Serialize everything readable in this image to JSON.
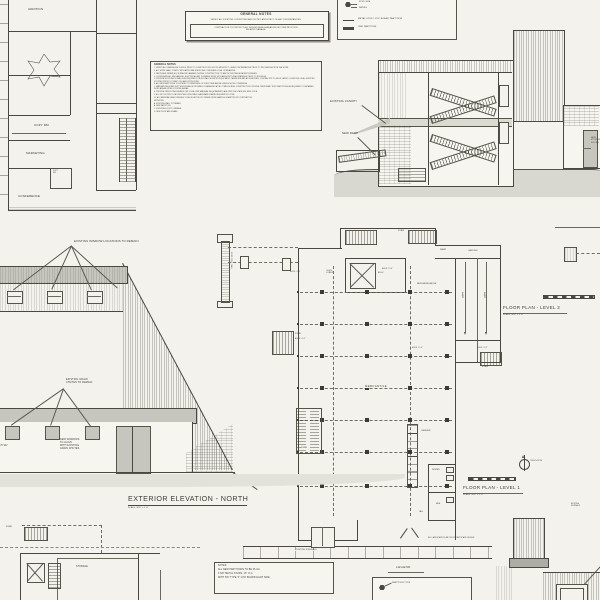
{
  "colors": {
    "paper": "#f4f2ec",
    "ink": "#4a4840",
    "gray_fill": "#c7c6be",
    "ground_gray": "#d9d8d0"
  },
  "plan_top_left": {
    "addition": "ADDITION",
    "copy_rm": "COPY RM.",
    "marketing": "MARKETING",
    "conference": "CONFERENCE",
    "copy_closet": "COPY\nRM."
  },
  "general_notes_box": {
    "title": "GENERAL NOTES",
    "line1": "VERIFY ALL EXISTING CONDITIONS AND NOTIFY ARCHITECT OF ANY DISCREPANCIES.",
    "line2": "CONTRACTOR TO PROTECT ALL NON-WORKING AREAS FROM CONSTRUCTION\nRELATED DAMAGE."
  },
  "notes_list": {
    "heading": "GENERAL NOTES",
    "items": [
      "1.  VERIFY ALL DIMENSIONS IN FIELD PRIOR TO CONSTRUCTION. NOTIFY ARCHITECT OF ANY DISCREPANCIES PRIOR TO PROCEEDING WITH THE WORK.",
      "2.  ALL WORK SHALL COMPLY WITH APPLICABLE BUILDING CODES AND LOCAL ORDINANCES.",
      "3.  PATCH AND REPAIR ALL SURFACES DAMAGED DURING CONSTRUCTION TO MATCH EXISTING ADJACENT FINISHES.",
      "4.  COORDINATE ALL MECHANICAL, ELECTRICAL AND PLUMBING WORK WITH ARCHITECTURAL DRAWINGS PRIOR TO ROUGH-IN.",
      "5.  PROVIDE BLOCKING IN WALLS AS REQUIRED FOR ALL WALL MOUNTED EQUIPMENT, CASEWORK AND ACCESSORIES. CONTRACTOR TO FIELD VERIFY LOCATIONS OF ALL EXISTING UTILITIES PRIOR TO START OF DEMOLITION WORK.",
      "6.  ALL NEW PARTITIONS TO EXTEND TO UNDERSIDE OF STRUCTURE ABOVE UNLESS NOTED OTHERWISE.",
      "7.  MAINTAIN REQUIRED EXIT WIDTHS AND ACCESSIBLE CLEARANCES AT ALL TIMES DURING CONSTRUCTION. PROVIDE TEMPORARY DUST PARTITIONS AS REQUIRED TO SEPARATE WORK AREAS FROM OCCUPIED AREAS.",
      "8.  PROVIDE FIRE EXTINGUISHERS PER LOCAL FIRE MARSHAL REQUIREMENTS AND PER THE STATE BUILDING CODE.",
      "9.  ALL EXIT DOORS TO BE PROVIDED WITH PANIC HARDWARE WHERE REQUIRED BY CODE.",
      "10. ALL MATERIALS AND FINISHES TO BE SELECTED BY OWNER FROM SAMPLES SUBMITTED BY CONTRACTOR.",
      "KEYNOTES:",
      "A.  EXISTING WALL TO REMAIN",
      "B.  NEW PARTITION",
      "C.  EXISTING DOOR TO REMAIN",
      "D.  NEW DOOR AND FRAME"
    ]
  },
  "legend_top": {
    "callout_top": "STUD SIZE",
    "callout_bottom": "RATING",
    "row1": "METAL STUD / GYP. BOARD PARTITION",
    "row2": "CMU PARTITION"
  },
  "section": {
    "existing_canopy": "EXISTING CANOPY",
    "new_ramp": "NEW RAMP",
    "right_label": "NEW\nSTOREFRONT\nDOORS"
  },
  "elevation_north": {
    "windows_label": "EXISTING WINDOW LOCATIONS TO REMAIN",
    "chutes_label": "EXISTING GRAIN\nCHUTES TO REMAIN",
    "new_windows_label": "NEW WINDOWS\nTO ALIGN\nWITH EXISTING\nGRAIN CHUTES.",
    "barn_doors_label": "NEW\n\"BARN-STYLE\"\nDOORS",
    "title": "EXTERIOR ELEVATION - NORTH",
    "scale": "SCALE: 3/32\" = 1'-0\""
  },
  "plan_level1": {
    "title": "FLOOR PLAN - LEVEL 1",
    "scale": "SCALE: 3/32\" = 1'-0\"",
    "true_north": "TRUE NORTH",
    "mercantile": "MERCANTILE",
    "mezzanine": "MEZZANINE ABOVE",
    "cashier": "CASHIER",
    "women": "WOMEN",
    "men": "MEN",
    "jan": "JAN.",
    "stair": "STAIR",
    "ramp": "RAMP",
    "landing": "LANDING",
    "elev_lobby": "ELEV.\nLOBBY",
    "elev": "ELEV.",
    "elev_46": "ELEV: 4'-6\"",
    "elev_94": "ELEV: 9'-4\"",
    "elev_36": "ELEV: 3'-6\"",
    "elev_42": "ELEV: 4'-2\""
  },
  "plan_level2": {
    "title": "FLOOR PLAN - LEVEL 2",
    "scale": "SCALE: 3/32\" = 1'-0\""
  },
  "plan_storage": {
    "stair": "STAIR",
    "storage": "STORAGE"
  },
  "sidewalk": {
    "label": "EXISTING SIDEWALK",
    "note": "RE: LANDSCAPE PLAN FOR STREETSCAPE DESIGN"
  },
  "notes_box": {
    "lines": [
      "NOTES:",
      "ALL NEW PARTITIONS TO BE 25 GA.",
      "3 5/8\" METAL STUDS, 16\" O.C.",
      "WITH 5/8\" TYPE 'X' GYP. BOARD EACH SIDE"
    ]
  },
  "legend_bottom": {
    "title": "LEGEND",
    "partition_type": "PARTITION TYPE"
  },
  "misc": {
    "wall_detail": "EXIST. CONC. WALL",
    "tiny_note": "EXISTING\nSIDEWALK"
  }
}
